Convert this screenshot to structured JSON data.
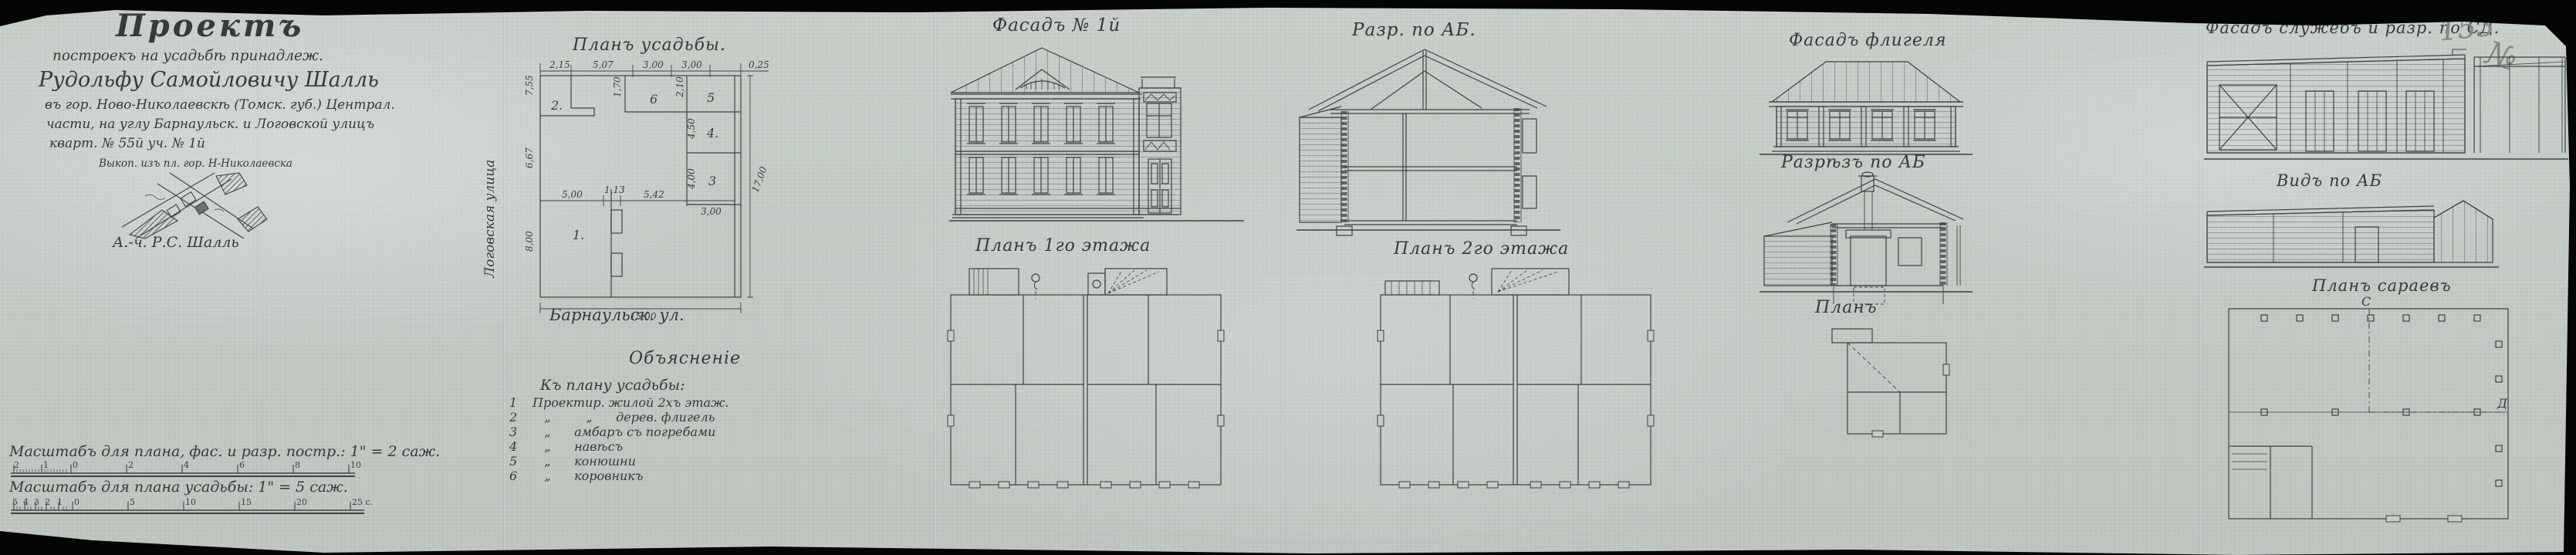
{
  "colors": {
    "paper": "#c5ccc6",
    "ink": "#363c3f",
    "pencil": "#84897f"
  },
  "header": {
    "title": "Проектъ",
    "line1": "построекъ на усадьбѣ принадлеж.",
    "line2": "Рудольфу Самойловичу Шалль",
    "line3": "въ гор. Ново-Николаевскѣ (Томск. губ.) Централ.",
    "line4": "части, на углу Барнаульск. и Логовской улицъ",
    "line5": "кварт. № 55й  уч. № 1й",
    "sketch_caption": "Выкоп. изъ пл. гор. Н-Николаевска",
    "signature": "А.-ч. Р.С. Шалль"
  },
  "site_plan": {
    "title": "Планъ усадьбы.",
    "street_left": "Логовская улица",
    "street_bottom": "Барнаульск. ул.",
    "rooms": {
      "r1": "1.",
      "r2": "2.",
      "r3": "3",
      "r4": "4.",
      "r5": "5",
      "r6": "6"
    },
    "dims": {
      "top1": "2,15",
      "top2": "5,07",
      "top3": "3,00",
      "top4": "3,00",
      "top5": "0,25",
      "left1": "7,55",
      "left2": "6,67",
      "left3": "8,00",
      "small1": "1,70",
      "small2": "2,10",
      "mid1": "5,00",
      "mid2": "1,13",
      "mid3": "5,42",
      "mid4": "3,00",
      "v4": "4,50",
      "v3": "4,00",
      "bottom": "15,00",
      "right": "17,00"
    }
  },
  "legend": {
    "title": "Объясненіе",
    "subtitle": "Къ плану усадьбы:",
    "items": [
      {
        "n": "1",
        "t": "Проектир. жилой 2хъ этаж."
      },
      {
        "n": "2",
        "t": "   „         „      дерев. флигель"
      },
      {
        "n": "3",
        "t": "   „      амбаръ съ погребами"
      },
      {
        "n": "4",
        "t": "   „      навѣсъ"
      },
      {
        "n": "5",
        "t": "   „      конюшни"
      },
      {
        "n": "6",
        "t": "   „      коровникъ"
      }
    ]
  },
  "scales": {
    "scale1_label": "Масштабъ для плана, фас. и разр. постр.:  1\" = 2 саж.",
    "scale1_ticks": [
      "2",
      "1",
      "0",
      "2",
      "4",
      "6",
      "8",
      "10"
    ],
    "scale2_label": "Масштабъ для плана усадьбы:  1\" = 5 саж.",
    "scale2_ticks": [
      "5",
      "4",
      "3",
      "2",
      "1",
      "0",
      "5",
      "10",
      "15",
      "20",
      "25 c."
    ]
  },
  "titles": {
    "facade1": "Фасадъ № 1й",
    "section_main": "Разр. по АБ.",
    "plan_floor1": "Планъ 1го этажа",
    "plan_floor2": "Планъ 2го этажа",
    "flegel_facade": "Фасадъ флигеля",
    "flegel_section": "Разрѣзъ по АБ",
    "flegel_plan": "Планъ",
    "sheds_facade": "Фасадъ служебъ и разр. по СД.",
    "sheds_view": "Видъ по АБ",
    "sheds_plan": "Планъ сараевъ"
  },
  "pencil_marks": {
    "page_number": "153",
    "numero": "№"
  },
  "section_marks": {
    "c": "С",
    "d": "Д"
  }
}
